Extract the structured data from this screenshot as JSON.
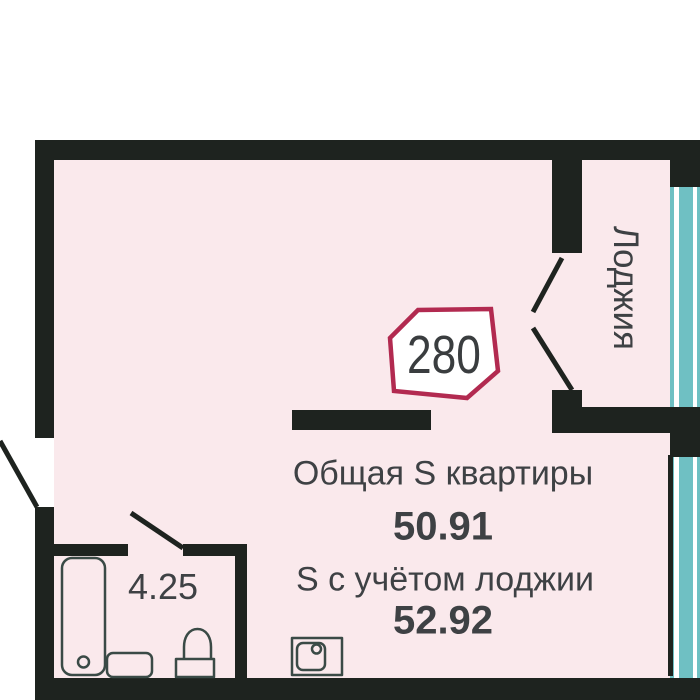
{
  "floor_plan": {
    "unit_badge": "280",
    "rooms": {
      "loggia_label": "Лоджия",
      "bathroom_area": "4.25"
    },
    "summary": {
      "total_label": "Общая S квартиры",
      "total_value": "50.91",
      "with_loggia_label": "S с учётом лоджии",
      "with_loggia_value": "52.92"
    },
    "icons": {
      "bathtub": "bathtub-icon",
      "washer": "washer-icon",
      "toilet": "toilet-icon",
      "sink": "sink-icon",
      "windows": "loggia-window-stripes"
    },
    "colors": {
      "wall": "#1e231f",
      "interior": "#fae9ec",
      "window_teal": "#6fc0c3",
      "badge_border": "#b22a50",
      "text": "#3e4144",
      "fixture_outline": "#3a4a46"
    }
  }
}
